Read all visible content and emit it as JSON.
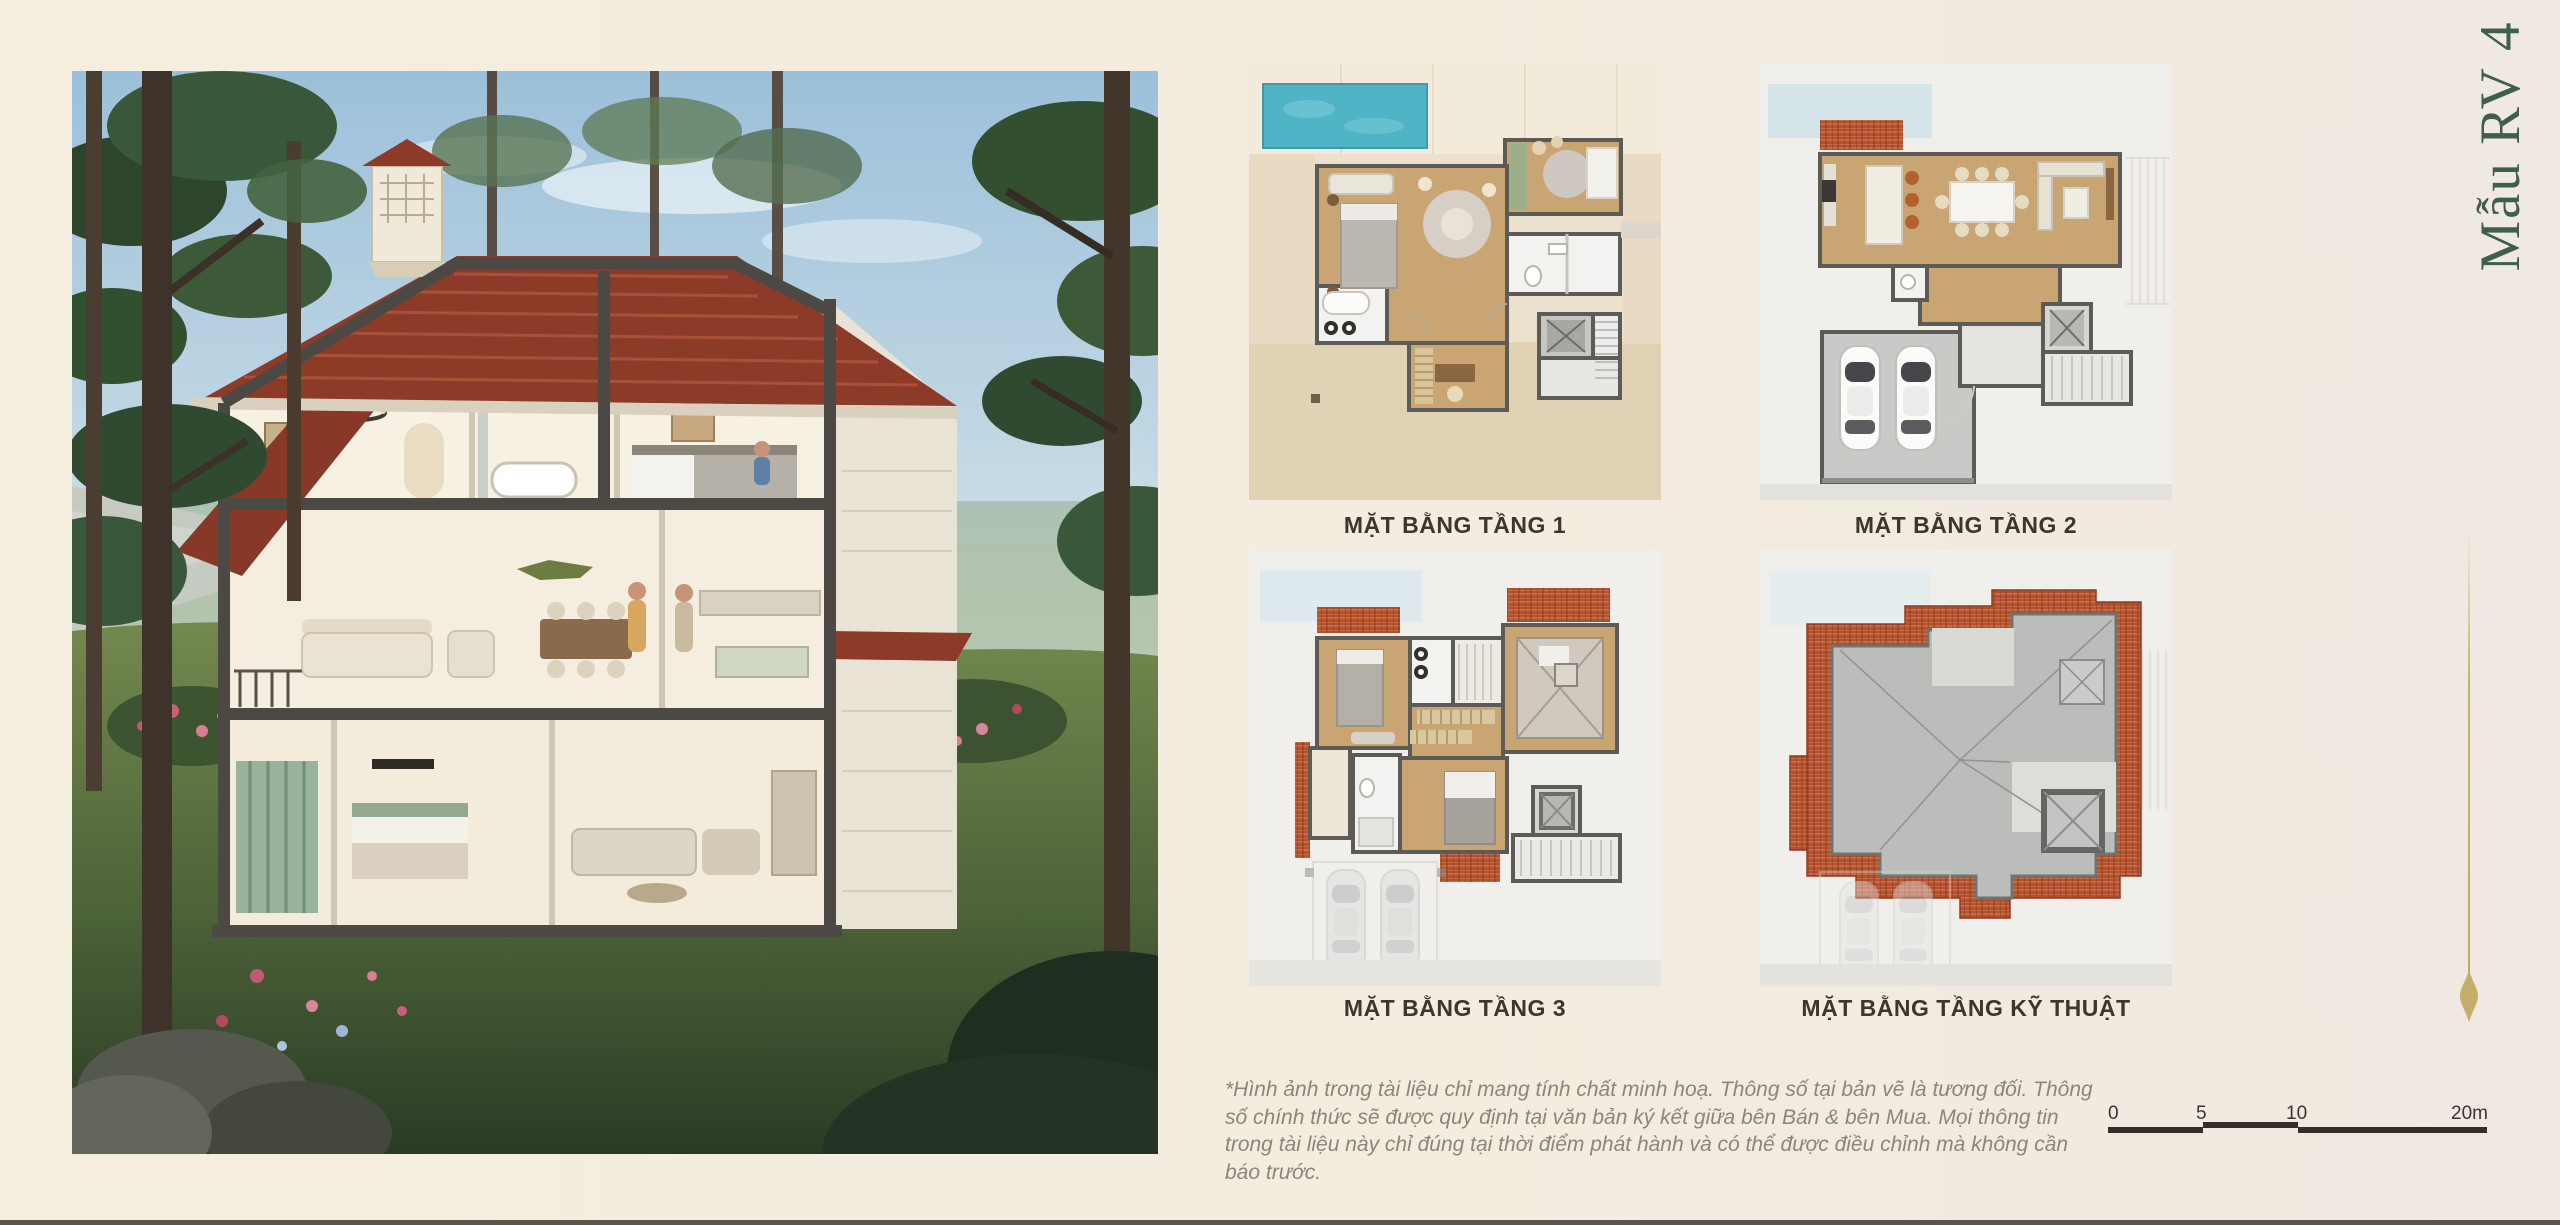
{
  "page": {
    "vertical_title": "Mẫu RV 4",
    "disclaimer": "*Hình ảnh trong tài liệu chỉ mang tính chất minh hoạ. Thông số tại bản vẽ là tương đối. Thông số chính thức sẽ được quy định tại văn bản ký kết giữa bên Bán & bên Mua. Mọi thông tin trong tài liệu này chỉ đúng tại thời điểm phát hành và có thể được điều chỉnh mà không cần báo trước."
  },
  "plans": [
    {
      "id": "tang-1",
      "label": "MẶT BẰNG TẦNG 1"
    },
    {
      "id": "tang-2",
      "label": "MẶT BẰNG TẦNG 2"
    },
    {
      "id": "tang-3",
      "label": "MẶT BẰNG TẦNG 3"
    },
    {
      "id": "tang-ky-thuat",
      "label": "MẶT BẰNG TẦNG KỸ THUẬT"
    }
  ],
  "scale_bar": {
    "ticks": [
      "0",
      "5",
      "10",
      "20m"
    ]
  },
  "colors": {
    "background": "#f4ecdf",
    "title_green": "#3e5f49",
    "gold_accent": "#c4b06e",
    "label_text": "#3b362e",
    "disclaimer_text": "#8b857a",
    "scale_bar": "#332e28",
    "pool_teal": "#4fb4c6",
    "roof_tile": "#b5512f",
    "wood_floor": "#c9a574",
    "wall_gray": "#5d5b56"
  }
}
